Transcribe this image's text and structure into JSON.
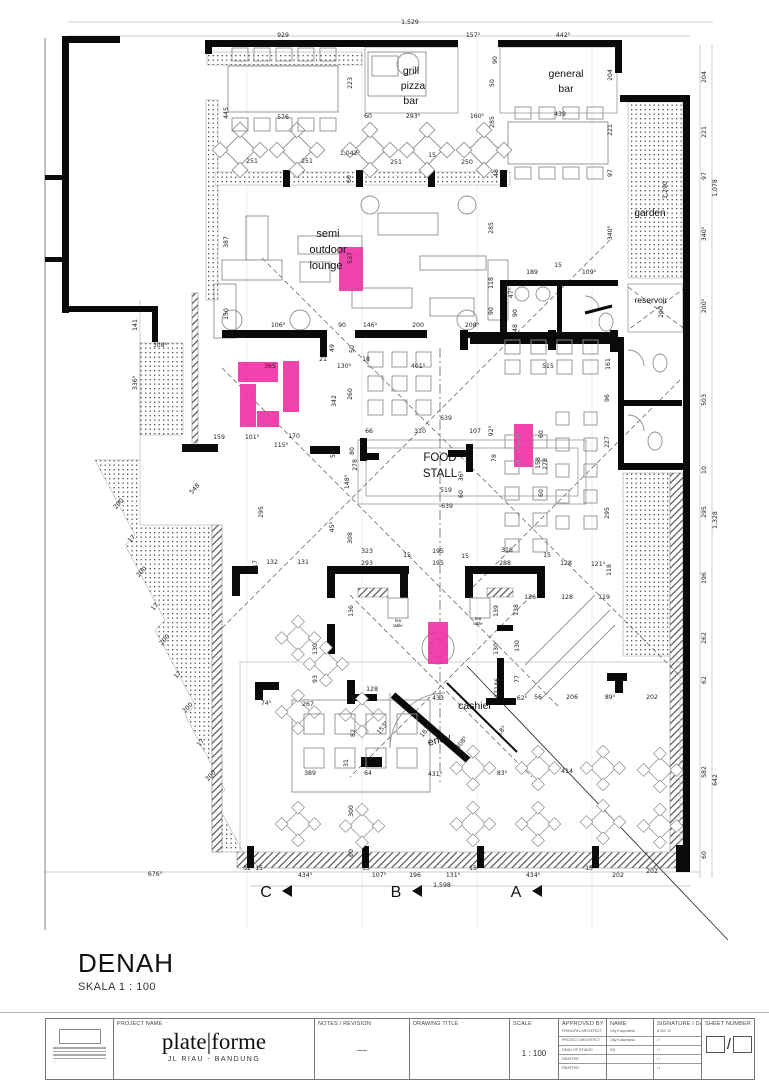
{
  "title": {
    "name": "DENAH",
    "scale": "SKALA 1 : 100"
  },
  "plan": {
    "highlight_color": "#f02fa2",
    "highlights": [
      {
        "x": 339,
        "y": 247,
        "w": 24,
        "h": 44
      },
      {
        "x": 238,
        "y": 362,
        "w": 40,
        "h": 20
      },
      {
        "x": 240,
        "y": 384,
        "w": 16,
        "h": 43
      },
      {
        "x": 257,
        "y": 411,
        "w": 22,
        "h": 16
      },
      {
        "x": 283,
        "y": 361,
        "w": 16,
        "h": 51
      },
      {
        "x": 514,
        "y": 424,
        "w": 19,
        "h": 43
      },
      {
        "x": 428,
        "y": 622,
        "w": 20,
        "h": 42
      }
    ],
    "room_labels": [
      {
        "t": "semi",
        "x": 328,
        "y": 237,
        "s": 11
      },
      {
        "t": "outdoor",
        "x": 328,
        "y": 253,
        "s": 11
      },
      {
        "t": "lounge",
        "x": 326,
        "y": 269,
        "s": 11
      },
      {
        "t": "grill",
        "x": 411,
        "y": 74,
        "s": 10.5
      },
      {
        "t": "pizza",
        "x": 413,
        "y": 89,
        "s": 10.5
      },
      {
        "t": "bar",
        "x": 411,
        "y": 104,
        "s": 10.5
      },
      {
        "t": "general",
        "x": 566,
        "y": 77,
        "s": 10.5
      },
      {
        "t": "bar",
        "x": 566,
        "y": 92,
        "s": 10.5
      },
      {
        "t": "garden",
        "x": 650,
        "y": 216,
        "s": 10
      },
      {
        "t": "reservoir",
        "x": 651,
        "y": 303,
        "s": 8.5
      },
      {
        "t": "FOOD",
        "x": 440,
        "y": 461,
        "s": 11.5
      },
      {
        "t": "STALL",
        "x": 440,
        "y": 477,
        "s": 11.5
      },
      {
        "t": "tea",
        "x": 398,
        "y": 622,
        "s": 4.3
      },
      {
        "t": "table",
        "x": 398,
        "y": 627,
        "s": 4.3
      },
      {
        "t": "tea",
        "x": 478,
        "y": 620,
        "s": 4.3
      },
      {
        "t": "table",
        "x": 478,
        "y": 625,
        "s": 4.3
      },
      {
        "t": "cashier",
        "x": 475,
        "y": 709,
        "s": 10.5
      },
      {
        "t": "entry",
        "x": 440,
        "y": 743,
        "s": 10.5,
        "r": -14
      }
    ],
    "section_markers": [
      {
        "label": "C",
        "x": 266,
        "y": 897
      },
      {
        "label": "B",
        "x": 396,
        "y": 897
      },
      {
        "label": "A",
        "x": 516,
        "y": 897
      }
    ],
    "dim_labels": [
      {
        "t": "1,529",
        "x": 410,
        "y": 24
      },
      {
        "t": "929",
        "x": 283,
        "y": 37
      },
      {
        "t": "157⁵",
        "x": 473,
        "y": 37
      },
      {
        "t": "442⁵",
        "x": 563,
        "y": 37
      },
      {
        "t": "445",
        "x": 228,
        "y": 113,
        "r": -90
      },
      {
        "t": "576",
        "x": 283,
        "y": 119
      },
      {
        "t": "60",
        "x": 368,
        "y": 118
      },
      {
        "t": "293⁵",
        "x": 413,
        "y": 118
      },
      {
        "t": "160⁵",
        "x": 477,
        "y": 118
      },
      {
        "t": "439",
        "x": 560,
        "y": 116
      },
      {
        "t": "223",
        "x": 352,
        "y": 83,
        "r": -90
      },
      {
        "t": "90",
        "x": 497,
        "y": 60,
        "r": -90
      },
      {
        "t": "50",
        "x": 494,
        "y": 83,
        "r": -90
      },
      {
        "t": "285",
        "x": 494,
        "y": 122,
        "r": -90
      },
      {
        "t": "285",
        "x": 493,
        "y": 228,
        "r": -90
      },
      {
        "t": "251",
        "x": 252,
        "y": 163
      },
      {
        "t": "251",
        "x": 307,
        "y": 163
      },
      {
        "t": "1,042⁵",
        "x": 350,
        "y": 155
      },
      {
        "t": "251",
        "x": 396,
        "y": 164
      },
      {
        "t": "15",
        "x": 432,
        "y": 157
      },
      {
        "t": "250",
        "x": 467,
        "y": 164
      },
      {
        "t": "60",
        "x": 351,
        "y": 179,
        "r": -90
      },
      {
        "t": "48",
        "x": 498,
        "y": 173,
        "r": -90
      },
      {
        "t": "204",
        "x": 612,
        "y": 75,
        "r": -90
      },
      {
        "t": "221",
        "x": 612,
        "y": 130,
        "r": -90
      },
      {
        "t": "97",
        "x": 612,
        "y": 173,
        "r": -90
      },
      {
        "t": "340⁵",
        "x": 612,
        "y": 233,
        "r": -90
      },
      {
        "t": "204",
        "x": 706,
        "y": 77,
        "r": -90
      },
      {
        "t": "221",
        "x": 706,
        "y": 132,
        "r": -90
      },
      {
        "t": "97",
        "x": 706,
        "y": 176,
        "r": -90
      },
      {
        "t": "1,078",
        "x": 717,
        "y": 188,
        "r": -90
      },
      {
        "t": "340⁵",
        "x": 706,
        "y": 234,
        "r": -90
      },
      {
        "t": "200⁵",
        "x": 706,
        "y": 306,
        "r": -90
      },
      {
        "t": "1,290",
        "x": 667,
        "y": 190,
        "r": -90
      },
      {
        "t": "189",
        "x": 532,
        "y": 274
      },
      {
        "t": "15",
        "x": 558,
        "y": 267
      },
      {
        "t": "109⁵",
        "x": 589,
        "y": 274
      },
      {
        "t": "118",
        "x": 493,
        "y": 283,
        "r": -90
      },
      {
        "t": "90",
        "x": 493,
        "y": 311,
        "r": -90
      },
      {
        "t": "47⁵",
        "x": 513,
        "y": 293,
        "r": -90
      },
      {
        "t": "90",
        "x": 517,
        "y": 313,
        "r": -90
      },
      {
        "t": "48",
        "x": 517,
        "y": 328,
        "r": -90
      },
      {
        "t": "44",
        "x": 506,
        "y": 326,
        "r": -90
      },
      {
        "t": "200",
        "x": 663,
        "y": 312,
        "r": -90
      },
      {
        "t": "387",
        "x": 228,
        "y": 242,
        "r": -90
      },
      {
        "t": "537",
        "x": 352,
        "y": 258,
        "r": -90
      },
      {
        "t": "150",
        "x": 228,
        "y": 314,
        "r": -90
      },
      {
        "t": "106⁵",
        "x": 278,
        "y": 327
      },
      {
        "t": "90",
        "x": 342,
        "y": 327
      },
      {
        "t": "146⁵",
        "x": 370,
        "y": 327
      },
      {
        "t": "200",
        "x": 418,
        "y": 327
      },
      {
        "t": "208⁵",
        "x": 472,
        "y": 327
      },
      {
        "t": "141",
        "x": 137,
        "y": 325,
        "r": -90
      },
      {
        "t": "336⁵",
        "x": 137,
        "y": 383,
        "r": -90
      },
      {
        "t": "308⁵",
        "x": 160,
        "y": 347
      },
      {
        "t": "365",
        "x": 270,
        "y": 368
      },
      {
        "t": "21",
        "x": 323,
        "y": 361
      },
      {
        "t": "130⁵",
        "x": 344,
        "y": 368
      },
      {
        "t": "18",
        "x": 366,
        "y": 361
      },
      {
        "t": "401⁵",
        "x": 418,
        "y": 368
      },
      {
        "t": "49",
        "x": 334,
        "y": 348,
        "r": -90
      },
      {
        "t": "50",
        "x": 354,
        "y": 349,
        "r": -90
      },
      {
        "t": "260",
        "x": 352,
        "y": 394,
        "r": -90
      },
      {
        "t": "342",
        "x": 336,
        "y": 401,
        "r": -90
      },
      {
        "t": "159",
        "x": 219,
        "y": 439
      },
      {
        "t": "101⁵",
        "x": 252,
        "y": 439
      },
      {
        "t": "115⁵",
        "x": 281,
        "y": 447
      },
      {
        "t": "170",
        "x": 294,
        "y": 438
      },
      {
        "t": "52",
        "x": 335,
        "y": 454,
        "r": -90
      },
      {
        "t": "639",
        "x": 446,
        "y": 420
      },
      {
        "t": "66",
        "x": 369,
        "y": 433
      },
      {
        "t": "310",
        "x": 420,
        "y": 433
      },
      {
        "t": "107",
        "x": 475,
        "y": 433
      },
      {
        "t": "92⁵",
        "x": 493,
        "y": 431,
        "r": -90
      },
      {
        "t": "80",
        "x": 354,
        "y": 451,
        "r": -90
      },
      {
        "t": "278",
        "x": 357,
        "y": 465,
        "r": -90
      },
      {
        "t": "148⁵",
        "x": 349,
        "y": 482,
        "r": -90
      },
      {
        "t": "519",
        "x": 446,
        "y": 492
      },
      {
        "t": "639",
        "x": 447,
        "y": 508
      },
      {
        "t": "36⁵",
        "x": 463,
        "y": 476,
        "r": -90
      },
      {
        "t": "60",
        "x": 463,
        "y": 494,
        "r": -90
      },
      {
        "t": "78",
        "x": 496,
        "y": 458,
        "r": -90
      },
      {
        "t": "60",
        "x": 543,
        "y": 434,
        "r": -90
      },
      {
        "t": "158",
        "x": 540,
        "y": 463,
        "r": -90
      },
      {
        "t": "278",
        "x": 547,
        "y": 464,
        "r": -90
      },
      {
        "t": "60",
        "x": 543,
        "y": 493,
        "r": -90
      },
      {
        "t": "515",
        "x": 548,
        "y": 368
      },
      {
        "t": "161",
        "x": 610,
        "y": 364,
        "r": -90
      },
      {
        "t": "96",
        "x": 609,
        "y": 398,
        "r": -90
      },
      {
        "t": "227",
        "x": 609,
        "y": 442,
        "r": -90
      },
      {
        "t": "295",
        "x": 609,
        "y": 513,
        "r": -90
      },
      {
        "t": "503",
        "x": 706,
        "y": 400,
        "r": -90
      },
      {
        "t": "10",
        "x": 706,
        "y": 470,
        "r": -90
      },
      {
        "t": "295",
        "x": 706,
        "y": 512,
        "r": -90
      },
      {
        "t": "1,328",
        "x": 717,
        "y": 520,
        "r": -90
      },
      {
        "t": "196",
        "x": 706,
        "y": 578,
        "r": -90
      },
      {
        "t": "262",
        "x": 706,
        "y": 638,
        "r": -90
      },
      {
        "t": "62",
        "x": 706,
        "y": 680,
        "r": -90
      },
      {
        "t": "582",
        "x": 706,
        "y": 772,
        "r": -90
      },
      {
        "t": "642",
        "x": 717,
        "y": 780,
        "r": -90
      },
      {
        "t": "60",
        "x": 706,
        "y": 855,
        "r": -90
      },
      {
        "t": "318",
        "x": 507,
        "y": 552
      },
      {
        "t": "15",
        "x": 547,
        "y": 557
      },
      {
        "t": "288",
        "x": 505,
        "y": 565
      },
      {
        "t": "128",
        "x": 566,
        "y": 565
      },
      {
        "t": "121⁵",
        "x": 598,
        "y": 566
      },
      {
        "t": "118",
        "x": 611,
        "y": 570,
        "r": -90
      },
      {
        "t": "136",
        "x": 530,
        "y": 599
      },
      {
        "t": "128",
        "x": 567,
        "y": 599
      },
      {
        "t": "119",
        "x": 604,
        "y": 599
      },
      {
        "t": "138",
        "x": 518,
        "y": 610,
        "r": -90
      },
      {
        "t": "130",
        "x": 519,
        "y": 646,
        "r": -90
      },
      {
        "t": "77",
        "x": 519,
        "y": 679,
        "r": -90
      },
      {
        "t": "62⁵",
        "x": 522,
        "y": 700
      },
      {
        "t": "56",
        "x": 538,
        "y": 699
      },
      {
        "t": "206",
        "x": 572,
        "y": 699
      },
      {
        "t": "89⁵",
        "x": 610,
        "y": 699
      },
      {
        "t": "202",
        "x": 652,
        "y": 699
      },
      {
        "t": "202",
        "x": 652,
        "y": 873
      },
      {
        "t": "308",
        "x": 352,
        "y": 538,
        "r": -90
      },
      {
        "t": "45⁵",
        "x": 334,
        "y": 527,
        "r": -90
      },
      {
        "t": "323",
        "x": 367,
        "y": 553
      },
      {
        "t": "15",
        "x": 407,
        "y": 557
      },
      {
        "t": "195",
        "x": 438,
        "y": 553
      },
      {
        "t": "15",
        "x": 465,
        "y": 558
      },
      {
        "t": "131",
        "x": 303,
        "y": 564
      },
      {
        "t": "132",
        "x": 272,
        "y": 564
      },
      {
        "t": "117",
        "x": 257,
        "y": 566,
        "r": -90
      },
      {
        "t": "293",
        "x": 367,
        "y": 565
      },
      {
        "t": "195",
        "x": 438,
        "y": 565
      },
      {
        "t": "136",
        "x": 353,
        "y": 611,
        "r": -90
      },
      {
        "t": "139",
        "x": 498,
        "y": 611,
        "r": -90
      },
      {
        "t": "130",
        "x": 317,
        "y": 649,
        "r": -90
      },
      {
        "t": "130",
        "x": 498,
        "y": 649,
        "r": -90
      },
      {
        "t": "93",
        "x": 317,
        "y": 679,
        "r": -90
      },
      {
        "t": "146",
        "x": 499,
        "y": 684,
        "r": -90
      },
      {
        "t": "37",
        "x": 499,
        "y": 694,
        "r": -90
      },
      {
        "t": "433",
        "x": 438,
        "y": 700
      },
      {
        "t": "153⁵",
        "x": 384,
        "y": 729,
        "r": -52
      },
      {
        "t": "163⁵",
        "x": 427,
        "y": 732,
        "r": -52
      },
      {
        "t": "308⁵",
        "x": 463,
        "y": 744,
        "r": -52
      },
      {
        "t": "18⁵",
        "x": 503,
        "y": 732,
        "r": -52
      },
      {
        "t": "431⁵",
        "x": 435,
        "y": 776
      },
      {
        "t": "64",
        "x": 368,
        "y": 775
      },
      {
        "t": "83⁵",
        "x": 502,
        "y": 775
      },
      {
        "t": "414",
        "x": 567,
        "y": 773
      },
      {
        "t": "31",
        "x": 348,
        "y": 763,
        "r": -90
      },
      {
        "t": "389",
        "x": 310,
        "y": 775
      },
      {
        "t": "300",
        "x": 353,
        "y": 811,
        "r": -90
      },
      {
        "t": "128",
        "x": 372,
        "y": 691
      },
      {
        "t": "74⁵",
        "x": 266,
        "y": 705
      },
      {
        "t": "267",
        "x": 308,
        "y": 706
      },
      {
        "t": "82",
        "x": 355,
        "y": 733,
        "r": -90
      },
      {
        "t": "60",
        "x": 353,
        "y": 853,
        "r": -90
      },
      {
        "t": "676⁵",
        "x": 155,
        "y": 876
      },
      {
        "t": "32",
        "x": 247,
        "y": 870
      },
      {
        "t": "15",
        "x": 259,
        "y": 870
      },
      {
        "t": "434⁵",
        "x": 305,
        "y": 877
      },
      {
        "t": "15",
        "x": 366,
        "y": 870
      },
      {
        "t": "107⁵",
        "x": 379,
        "y": 877
      },
      {
        "t": "196",
        "x": 415,
        "y": 877
      },
      {
        "t": "131⁵",
        "x": 453,
        "y": 877
      },
      {
        "t": "15",
        "x": 473,
        "y": 870
      },
      {
        "t": "434⁵",
        "x": 533,
        "y": 877
      },
      {
        "t": "15",
        "x": 589,
        "y": 870
      },
      {
        "t": "202",
        "x": 618,
        "y": 877
      },
      {
        "t": "1,598",
        "x": 442,
        "y": 887
      },
      {
        "t": "548",
        "x": 196,
        "y": 490,
        "r": -48
      },
      {
        "t": "200",
        "x": 120,
        "y": 505,
        "r": -48
      },
      {
        "t": "17",
        "x": 133,
        "y": 540,
        "r": -48
      },
      {
        "t": "200",
        "x": 143,
        "y": 573,
        "r": -48
      },
      {
        "t": "17",
        "x": 156,
        "y": 608,
        "r": -48
      },
      {
        "t": "200",
        "x": 166,
        "y": 641,
        "r": -48
      },
      {
        "t": "17",
        "x": 179,
        "y": 676,
        "r": -48
      },
      {
        "t": "200",
        "x": 189,
        "y": 709,
        "r": -48
      },
      {
        "t": "17",
        "x": 202,
        "y": 744,
        "r": -48
      },
      {
        "t": "200",
        "x": 212,
        "y": 777,
        "r": -48
      },
      {
        "t": "295",
        "x": 263,
        "y": 512,
        "r": -90
      }
    ]
  },
  "titleblock": {
    "headers": {
      "project": "PROJECT NAME",
      "notes": "NOTES / REVISION",
      "drawing": "DRAWING TITLE",
      "scale": "SCALE",
      "approved": "APPROVED BY",
      "name": "NAME",
      "signature": "SIGNATURE / DATE",
      "sheet": "SHEET NUMBER"
    },
    "firm": {
      "name": "plate|forme",
      "address": "JL RIAU - BANDUNG"
    },
    "notes_value": "—",
    "scale_value": "1 : 100",
    "sheet_slash": "/",
    "approvals": [
      {
        "role": "PRINCIPAL ARCHITECT",
        "name": "Oky Kuspriatna",
        "date": "8 /02/ 10"
      },
      {
        "role": "PROJECT ARCHITECT",
        "name": "Oky Kuspriatna",
        "date": "/ /"
      },
      {
        "role": "HEAD OF STUDIO",
        "name": "DG",
        "date": "/ /"
      },
      {
        "role": "DRAFTER",
        "name": "",
        "date": "/ /"
      },
      {
        "role": "DRAFTER",
        "name": "-",
        "date": "/ /"
      }
    ]
  }
}
